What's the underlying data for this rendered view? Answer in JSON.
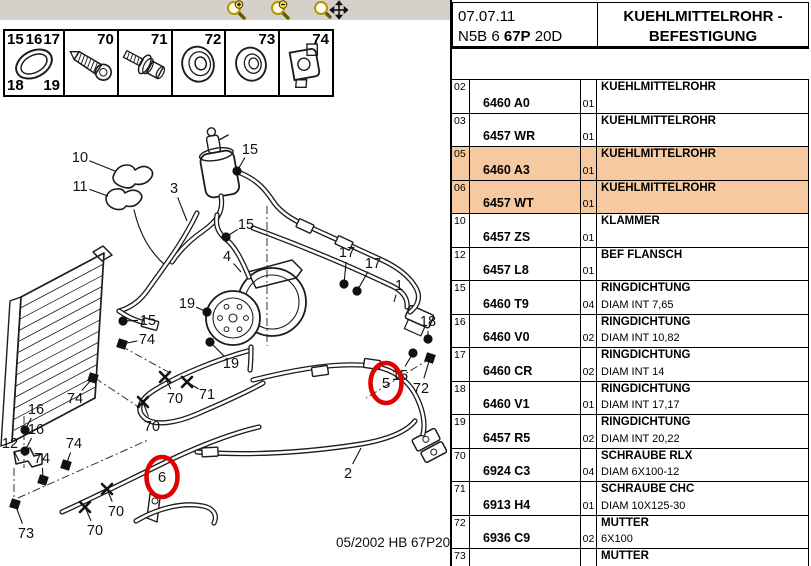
{
  "header": {
    "date": "07.07.11",
    "code": {
      "pre": "N5B 6 ",
      "bold": "67P",
      "post": " 20D"
    },
    "title1": "KUEHLMITTELROHR -",
    "title2": "BEFESTIGUNG"
  },
  "toolbar": {
    "icons": [
      {
        "name": "zoom-in"
      },
      {
        "name": "zoom-out"
      },
      {
        "name": "zoom-pan"
      }
    ]
  },
  "legend": {
    "cells": [
      {
        "icon": "o-ring",
        "numbers": [
          {
            "t": "15",
            "pos": "tl"
          },
          {
            "t": "16",
            "pos": "tc"
          },
          {
            "t": "17",
            "pos": "tr"
          },
          {
            "t": "18",
            "pos": "bl"
          },
          {
            "t": "19",
            "pos": "br"
          }
        ]
      },
      {
        "icon": "screw",
        "numbers": [
          {
            "t": "70",
            "pos": "tr"
          }
        ]
      },
      {
        "icon": "bolt-washer",
        "numbers": [
          {
            "t": "71",
            "pos": "tr"
          }
        ]
      },
      {
        "icon": "grommet",
        "numbers": [
          {
            "t": "72",
            "pos": "tr"
          }
        ]
      },
      {
        "icon": "washer",
        "numbers": [
          {
            "t": "73",
            "pos": "tr"
          }
        ]
      },
      {
        "icon": "clip-nut",
        "numbers": [
          {
            "t": "74",
            "pos": "tr"
          }
        ]
      }
    ]
  },
  "diagram": {
    "footer": "05/2002  HB 67P20D",
    "red": "#e10000",
    "labels": [
      {
        "t": "10",
        "x": 80,
        "y": 157,
        "lx": 115,
        "ly": 171,
        "m": "none"
      },
      {
        "t": "11",
        "x": 80,
        "y": 186,
        "lx": 108,
        "ly": 196,
        "m": "none"
      },
      {
        "t": "3",
        "x": 174,
        "y": 188,
        "lx": 187,
        "ly": 221,
        "m": "none"
      },
      {
        "t": "15",
        "x": 250,
        "y": 149,
        "lx": 237,
        "ly": 171,
        "m": "dot"
      },
      {
        "t": "15",
        "x": 246,
        "y": 224,
        "lx": 226,
        "ly": 237,
        "m": "dot"
      },
      {
        "t": "4",
        "x": 227,
        "y": 256,
        "lx": 241,
        "ly": 272,
        "m": "none"
      },
      {
        "t": "17",
        "x": 347,
        "y": 252,
        "lx": 344,
        "ly": 284,
        "m": "dot"
      },
      {
        "t": "17",
        "x": 373,
        "y": 263,
        "lx": 357,
        "ly": 291,
        "m": "dot"
      },
      {
        "t": "1",
        "x": 399,
        "y": 285,
        "lx": 394,
        "ly": 302,
        "m": "none"
      },
      {
        "t": "18",
        "x": 428,
        "y": 321,
        "lx": 428,
        "ly": 339,
        "m": "dot"
      },
      {
        "t": "15",
        "x": 400,
        "y": 375,
        "lx": 413,
        "ly": 353,
        "m": "dot"
      },
      {
        "t": "72",
        "x": 421,
        "y": 388,
        "lx": 430,
        "ly": 358,
        "m": "sq"
      },
      {
        "t": "19",
        "x": 187,
        "y": 303,
        "lx": 207,
        "ly": 312,
        "m": "dot"
      },
      {
        "t": "19",
        "x": 231,
        "y": 363,
        "lx": 210,
        "ly": 342,
        "m": "dot"
      },
      {
        "t": "15",
        "x": 148,
        "y": 320,
        "lx": 123,
        "ly": 321,
        "m": "dot"
      },
      {
        "t": "74",
        "x": 147,
        "y": 339,
        "lx": 122,
        "ly": 344,
        "m": "sq"
      },
      {
        "t": "16",
        "x": 36,
        "y": 409,
        "lx": 25,
        "ly": 430,
        "m": "dot"
      },
      {
        "t": "16",
        "x": 36,
        "y": 429,
        "lx": 25,
        "ly": 451,
        "m": "dot"
      },
      {
        "t": "12",
        "x": 10,
        "y": 443,
        "lx": 19,
        "ly": 461,
        "m": "none"
      },
      {
        "t": "74",
        "x": 75,
        "y": 398,
        "lx": 93,
        "ly": 378,
        "m": "sq"
      },
      {
        "t": "74",
        "x": 74,
        "y": 443,
        "lx": 66,
        "ly": 465,
        "m": "sq"
      },
      {
        "t": "74",
        "x": 42,
        "y": 458,
        "lx": 43,
        "ly": 480,
        "m": "sq"
      },
      {
        "t": "70",
        "x": 175,
        "y": 398,
        "lx": 165,
        "ly": 377,
        "m": "x"
      },
      {
        "t": "70",
        "x": 152,
        "y": 426,
        "lx": 143,
        "ly": 402,
        "m": "x"
      },
      {
        "t": "71",
        "x": 207,
        "y": 394,
        "lx": 187,
        "ly": 382,
        "m": "x"
      },
      {
        "t": "70",
        "x": 116,
        "y": 511,
        "lx": 107,
        "ly": 489,
        "m": "x"
      },
      {
        "t": "70",
        "x": 95,
        "y": 530,
        "lx": 85,
        "ly": 507,
        "m": "x"
      },
      {
        "t": "73",
        "x": 26,
        "y": 533,
        "lx": 15,
        "ly": 504,
        "m": "sq"
      },
      {
        "t": "2",
        "x": 348,
        "y": 473,
        "lx": 361,
        "ly": 448,
        "m": "none"
      }
    ],
    "circles": [
      {
        "t": "5",
        "x": 386,
        "y": 383
      },
      {
        "t": "6",
        "x": 162,
        "y": 477
      }
    ]
  },
  "table": {
    "highlight": "#f7c9a0",
    "rows": [
      {
        "ref": "02",
        "part": "6460 A0",
        "qty": "01",
        "name": "KUEHLMITTELROHR",
        "spec": "",
        "hl": false
      },
      {
        "ref": "03",
        "part": "6457 WR",
        "qty": "01",
        "name": "KUEHLMITTELROHR",
        "spec": "",
        "hl": false
      },
      {
        "ref": "05",
        "part": "6460 A3",
        "qty": "01",
        "name": "KUEHLMITTELROHR",
        "spec": "",
        "hl": true
      },
      {
        "ref": "06",
        "part": "6457 WT",
        "qty": "01",
        "name": "KUEHLMITTELROHR",
        "spec": "",
        "hl": true
      },
      {
        "ref": "10",
        "part": "6457 ZS",
        "qty": "01",
        "name": "KLAMMER",
        "spec": "",
        "hl": false
      },
      {
        "ref": "12",
        "part": "6457 L8",
        "qty": "01",
        "name": "BEF FLANSCH",
        "spec": "",
        "hl": false
      },
      {
        "ref": "15",
        "part": "6460 T9",
        "qty": "04",
        "name": "RINGDICHTUNG",
        "spec": "DIAM INT 7,65",
        "hl": false
      },
      {
        "ref": "16",
        "part": "6460 V0",
        "qty": "02",
        "name": "RINGDICHTUNG",
        "spec": "DIAM INT 10,82",
        "hl": false
      },
      {
        "ref": "17",
        "part": "6460 CR",
        "qty": "02",
        "name": "RINGDICHTUNG",
        "spec": "DIAM INT 14",
        "hl": false
      },
      {
        "ref": "18",
        "part": "6460 V1",
        "qty": "01",
        "name": "RINGDICHTUNG",
        "spec": "DIAM INT 17,17",
        "hl": false
      },
      {
        "ref": "19",
        "part": "6457 R5",
        "qty": "02",
        "name": "RINGDICHTUNG",
        "spec": "DIAM INT 20,22",
        "hl": false
      },
      {
        "ref": "70",
        "part": "6924 C3",
        "qty": "04",
        "name": "SCHRAUBE RLX",
        "spec": "DIAM 6X100-12",
        "hl": false
      },
      {
        "ref": "71",
        "part": "6913 H4",
        "qty": "01",
        "name": "SCHRAUBE CHC",
        "spec": "DIAM 10X125-30",
        "hl": false
      },
      {
        "ref": "72",
        "part": "6936 C9",
        "qty": "02",
        "name": "MUTTER",
        "spec": "6X100",
        "hl": false
      },
      {
        "ref": "73",
        "part": "",
        "qty": "",
        "name": "MUTTER",
        "spec": "",
        "hl": false
      }
    ]
  }
}
